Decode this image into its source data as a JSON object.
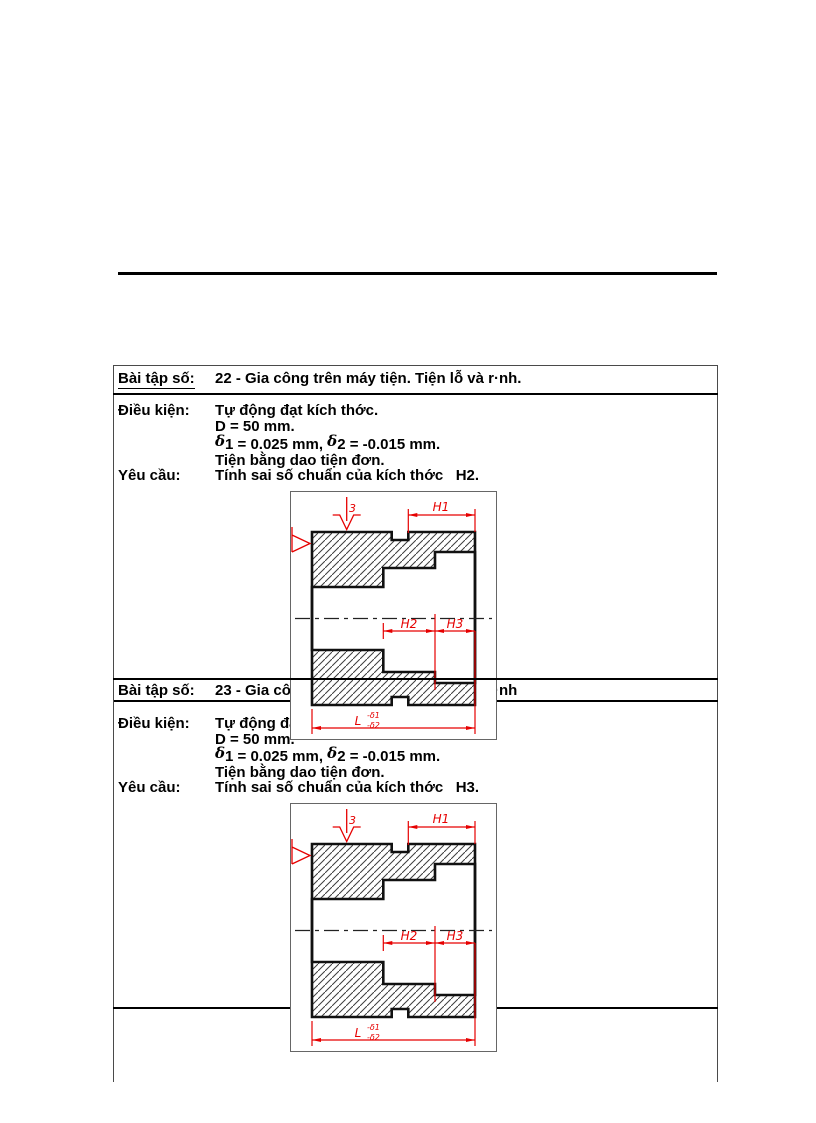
{
  "exercises": [
    {
      "row_label": "Bài tập số:",
      "title": "22 - Gia công trên máy tiện. Tiện lỗ và r·nh.",
      "cond_label": "Điều kiện:",
      "cond1": "Tự động đạt kích thớc.",
      "cond2": "D = 50 mm.",
      "delta": {
        "sym1": "δ",
        "seg1": "1 = 0.025 mm, ",
        "sym2": "δ",
        "seg2": "2 = -0.015 mm."
      },
      "cond4": "Tiện bằng dao tiện đơn.",
      "req_label": "Yêu cầu:",
      "req": "Tính sai số chuẩn của kích thớc   H2."
    },
    {
      "row_label": "Bài tập số:",
      "title": "23 - Gia công trên máy tiện. Tiện lỗ và r·nh",
      "cond_label": "Điều kiện:",
      "cond1": "Tự động đạt kích thớc.",
      "cond2": "D = 50 mm.",
      "delta": {
        "sym1": "δ",
        "seg1": "1 = 0.025 mm, ",
        "sym2": "δ",
        "seg2": "2 = -0.015 mm."
      },
      "cond4": "Tiện bằng dao tiện đơn.",
      "req_label": "Yêu cầu:",
      "req": "Tính sai số chuẩn của kích thớc   H3."
    }
  ],
  "drawing": {
    "h1": "H1",
    "h2": "H2",
    "h3": "H3",
    "l": "L",
    "tol_upper": "-δ1",
    "tol_lower": "-δ2",
    "roughness": "3"
  },
  "colors": {
    "dimension_red": "#e60000",
    "line_black": "#111111"
  }
}
